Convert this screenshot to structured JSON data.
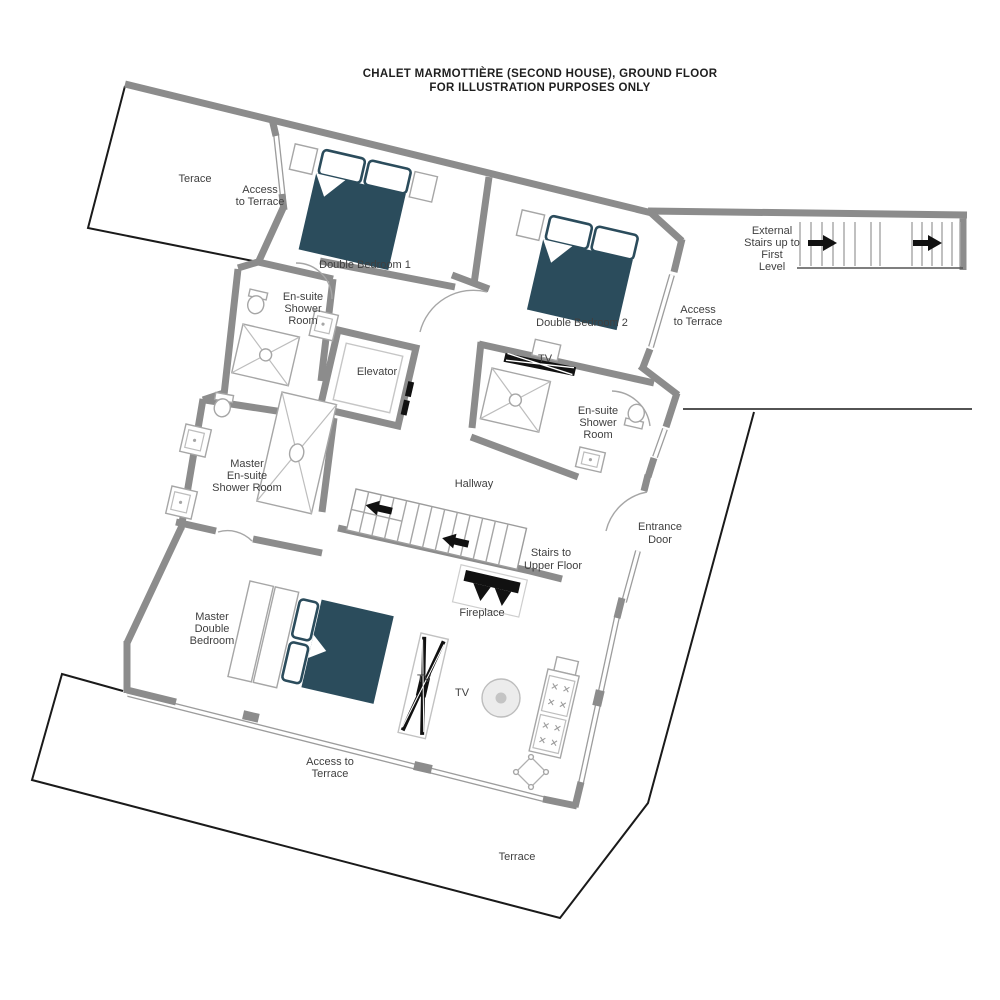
{
  "title": {
    "line1": "CHALET MARMOTTIÈRE (SECOND HOUSE), GROUND FLOOR",
    "line2": "FOR ILLUSTRATION PURPOSES ONLY"
  },
  "colors": {
    "wall_gray": "#8c8c8c",
    "outline_black": "#1a1a1a",
    "bed_teal": "#2b4c5c",
    "fixture_gray": "#a6a6a6",
    "text_gray": "#3f3f3f"
  },
  "rooms": {
    "terrace_top_left": "Terace",
    "access_terrace_top": {
      "l1": "Access",
      "l2": "to Terrace"
    },
    "double_bedroom_1": "Double Bedroom 1",
    "ensuite_1": {
      "l1": "En-suite",
      "l2": "Shower",
      "l3": "Room"
    },
    "elevator": "Elevator",
    "double_bedroom_2": "Double Bedroom 2",
    "access_terrace_right": {
      "l1": "Access",
      "l2": "to Terrace"
    },
    "external_stairs": {
      "l1": "External",
      "l2": "Stairs up to",
      "l3": "First",
      "l4": "Level"
    },
    "tv_bedroom2": "TV",
    "ensuite_2": {
      "l1": "En-suite",
      "l2": "Shower",
      "l3": "Room"
    },
    "master_ensuite": {
      "l1": "Master",
      "l2": "En-suite",
      "l3": "Shower Room"
    },
    "hallway": "Hallway",
    "stairs_upper": {
      "l1": "Stairs to",
      "l2": "Upper Floor"
    },
    "entrance_door": {
      "l1": "Entrance",
      "l2": "Door"
    },
    "fireplace": "Fireplace",
    "master_bedroom": {
      "l1": "Master",
      "l2": "Double",
      "l3": "Bedroom"
    },
    "tv_living_left": "TV",
    "tv_living_right": "TV",
    "access_terrace_bottom": {
      "l1": "Access to",
      "l2": "Terrace"
    },
    "terrace_bottom": "Terrace"
  }
}
